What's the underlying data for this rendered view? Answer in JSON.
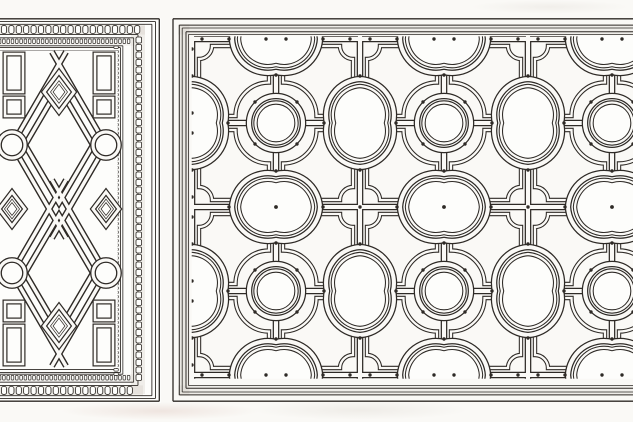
{
  "plate": {
    "name": "strapwork-ornament-plate",
    "type": "engraved architectural ornament drawing, no text",
    "panels": [
      {
        "name": "diamond-strapwork-panel",
        "position": "left",
        "motifs": "interlaced lozenges, cusped circles, small diamonds, corner rectangles, bead-and-reel frame"
      },
      {
        "name": "quatrefoil-ceiling-panel",
        "position": "right",
        "motifs": "rib grid with circles, tall and wide quatrefoils, concave-corner coffers, stud dots, moulded frame"
      }
    ]
  },
  "palette": {
    "ink": "#2e2a26",
    "paper": "#faf9f6",
    "panel_paper": "#fdfdfb",
    "frame_shade": "#d6d2ca"
  },
  "right_panel": {
    "frame": {
      "left": 173,
      "top": 18.8,
      "bottom": 401.2,
      "right_extent": 652,
      "rings": [
        {
          "o": 0,
          "w": 1.3
        },
        {
          "o": 6.3,
          "w": 1
        },
        {
          "o": 9.2,
          "w": 0.8
        },
        {
          "o": 13,
          "w": 1
        },
        {
          "o": 15.6,
          "w": 0.8
        }
      ]
    },
    "grid": {
      "origin_x": 192,
      "origin_y": 39,
      "step": 84,
      "cols": 6,
      "rows": 5
    },
    "strap": {
      "ink_w": 6.6,
      "paper_w": 4.1
    },
    "coffer": {
      "half": 35,
      "ink_w": 4.4,
      "paper_w": 2.3,
      "corner_r": {
        "circle": 33.5,
        "tall": 26,
        "wide": 26,
        "cross": 13
      }
    },
    "motifs": {
      "circle": {
        "r_outer": 27,
        "r_inner": 20.5
      },
      "tall_quatrefoil": {
        "cw": 33,
        "ch": 44,
        "r": 36,
        "icw": 26,
        "ich": 37,
        "ir": 29
      },
      "wide_quatrefoil": {
        "cw": 44,
        "ch": 33,
        "r": 36,
        "icw": 37,
        "ich": 26,
        "ir": 29
      }
    },
    "dots": {
      "r": 1.7,
      "circle_diag": 21,
      "cusp_gap": 3,
      "border_flank": 10
    },
    "covers": {
      "top_until": 36.3,
      "bottom_from": 378.7,
      "left_until": 191.7
    }
  },
  "left_panel": {
    "bounds": {
      "top": 18,
      "bottom": 403,
      "right": 161
    },
    "frame": {
      "outer_x_right": 159.3,
      "outer_y_top": 18.8,
      "outer_y_bottom": 401.2,
      "right_mult": 1.35,
      "rings": [
        {
          "o": 0,
          "w": 1.3
        },
        {
          "o": 2.8,
          "w": 0.9
        },
        {
          "o": 5.5,
          "w": 0.9
        },
        {
          "o": 15.8,
          "w": 0.9
        },
        {
          "o": 19,
          "w": 0.8
        },
        {
          "o": 27,
          "w": 0.8
        },
        {
          "o": 28.8,
          "w": 0.9
        },
        {
          "o": 31.6,
          "w": 0.9
        }
      ]
    },
    "beads": {
      "big": {
        "w": 5.2,
        "h": 7.9,
        "rx": 2.1,
        "step": 7.4,
        "col_w": 5.6,
        "col_h": 6.0,
        "col_step": 7.5
      },
      "small": {
        "w": 2.6,
        "h": 4.6,
        "step": 4.3,
        "col_w": 4.4,
        "col_h": 2.6,
        "col_step": 4.3
      }
    },
    "field": {
      "x0": 0,
      "y0": 50.4,
      "x1": 117.7,
      "y1": 368,
      "cx": 59
    },
    "strap": {
      "ink_w": 6.2,
      "paper_w": 3.4
    },
    "lozenges": {
      "top": {
        "cx": 59,
        "cy": 145,
        "hw": 47,
        "hh": 81,
        "ext": 14
      },
      "bottom": {
        "cx": 59,
        "cy": 273,
        "hw": 47,
        "hh": 81,
        "ext": 14
      },
      "inner_hw": 34,
      "inner_hh": 58
    },
    "circles": {
      "r": 13,
      "centers": [
        [
          12,
          145
        ],
        [
          106,
          145
        ],
        [
          12,
          273
        ],
        [
          106,
          273
        ]
      ]
    },
    "diamonds": [
      {
        "cx": 59,
        "cy": 92,
        "hw": 15,
        "hh": 20
      },
      {
        "cx": 59,
        "cy": 326,
        "hw": 15,
        "hh": 20
      },
      {
        "cx": 106,
        "cy": 209,
        "hw": 13,
        "hh": 17
      },
      {
        "cx": 12,
        "cy": 209,
        "hw": 13,
        "hh": 17
      }
    ],
    "rects": [
      [
        95,
        54,
        18,
        38
      ],
      [
        95,
        98,
        18,
        18
      ],
      [
        5,
        54,
        18,
        38
      ],
      [
        5,
        98,
        18,
        18
      ],
      [
        95,
        326,
        18,
        38
      ],
      [
        95,
        302,
        18,
        18
      ],
      [
        5,
        326,
        18,
        38
      ],
      [
        5,
        302,
        18,
        18
      ]
    ]
  }
}
